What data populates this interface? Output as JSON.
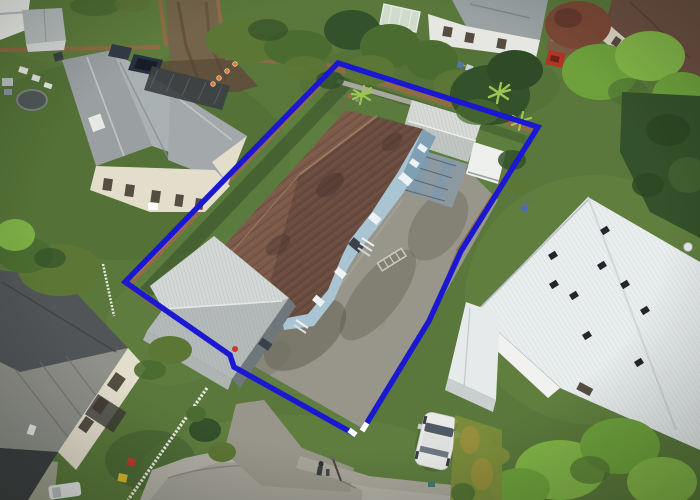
{
  "image": {
    "width": 700,
    "height": 500,
    "kind": "aerial-drone-photo",
    "subject": "residential property outlined in blue (real-estate boundary overlay)"
  },
  "boundary": {
    "points": "362,431 429,321 461,251 538,127 338,63 125,282 230,355 234,367 356,435",
    "cap_a": "362,431 367,423",
    "cap_b": "356,435 349,430",
    "stroke_width": 5.5
  },
  "legend": {
    "outlined_property": "single-storey house with terracotta tile roof, blue weatherboard walls, detached garage, carport, rear shed and long concrete driveway",
    "left_neighbor": "grey-roof duplex with pergola and two dark cars",
    "bottom_left_neighbor": "dark metal roof house with white picket fence",
    "right_neighbor": "large white corrugated-iron roof house with lawn",
    "street": "cul-de-sac with concrete footpath at bottom",
    "misc": "orange traffic cones on dirt driveway, trampoline, laundry lines, white station wagon, street light, pedestrian"
  },
  "colors": {
    "grass": "#5a783b",
    "grassLight": "#6c8a46",
    "grassBright": "#729148",
    "grassDark": "#44602e",
    "grassShadow": "#2f4525",
    "lawnInside": "#5f8242",
    "concrete": "#98968a",
    "concreteLight": "#a8a69a",
    "concreteDark": "#6f6d60",
    "stain": "#595747",
    "street": "#b2b0a5",
    "asphalt": "#a3a196",
    "dirt": "#74644b",
    "dirtDark": "#5c4e3a",
    "wood": "#8f6c45",
    "woodLight": "#a8814f",
    "picket": "#e9e9e1",
    "wallGray": "#a9a8a0",
    "blue": "#1a18d0",
    "cap": "#ffffff",
    "tile": "#7c5a4a",
    "tileDark": "#3a2b26",
    "ridge": "#9b7a64",
    "wallBlue": "#a9c4d3",
    "wallBlueDark": "#7fa0b4",
    "windowWhite": "#eef2f4",
    "door": "#39414a",
    "shedLight": "#d3d7d6",
    "shedDark": "#b4bab9",
    "shedWall": "#6e777b",
    "shedFace": "#aeb4b2",
    "carport": "#8d99a1",
    "carportRib": "#5d666d",
    "skylight": "#7e99ad",
    "rearShed": "#d7dad6",
    "rearShedDark": "#b9bfbb",
    "caravan": "#eef0ee",
    "roofL1": "#aab1b3",
    "roofL2": "#9aa0a2",
    "roofL3": "#a3a9ab",
    "cream": "#e3ddcc",
    "windowDark": "#554c42",
    "pergola": "#3c4143",
    "blDark": "#515558",
    "blMetal": "#8e9089",
    "blDeep": "#3d4043",
    "roofWhite": "#e9edee",
    "roofWhiteShade": "#c9d1d3",
    "vent": "#24262a",
    "wallWhite": "#f1f2ef",
    "treeDark": "#33512a",
    "treeMid": "#4a6c31",
    "treeOlive": "#5c7635",
    "treeBright": "#6ea13c",
    "treeVivid": "#82b548",
    "treeRed": "#7b4837",
    "palmC": "#9dc553",
    "hedgeOlive": "#7d8d3c",
    "hedgeOrange": "#a5913d",
    "cone": "#e07b28",
    "carWhite": "#e9eae7",
    "carGlass": "#4f5a64",
    "carDark": "#27313f",
    "redCar": "#b23425",
    "toyY": "#d6ba2c",
    "toyR": "#c23b28",
    "person": "#2e3336",
    "pole": "#4a463f",
    "tramp": "#4e5857",
    "trampRim": "#79827f",
    "greenhouse": "#cfdccc",
    "ghFrame": "#e8ebe6",
    "laundryB": "#5077ad",
    "ladder": "#c8c9be"
  }
}
